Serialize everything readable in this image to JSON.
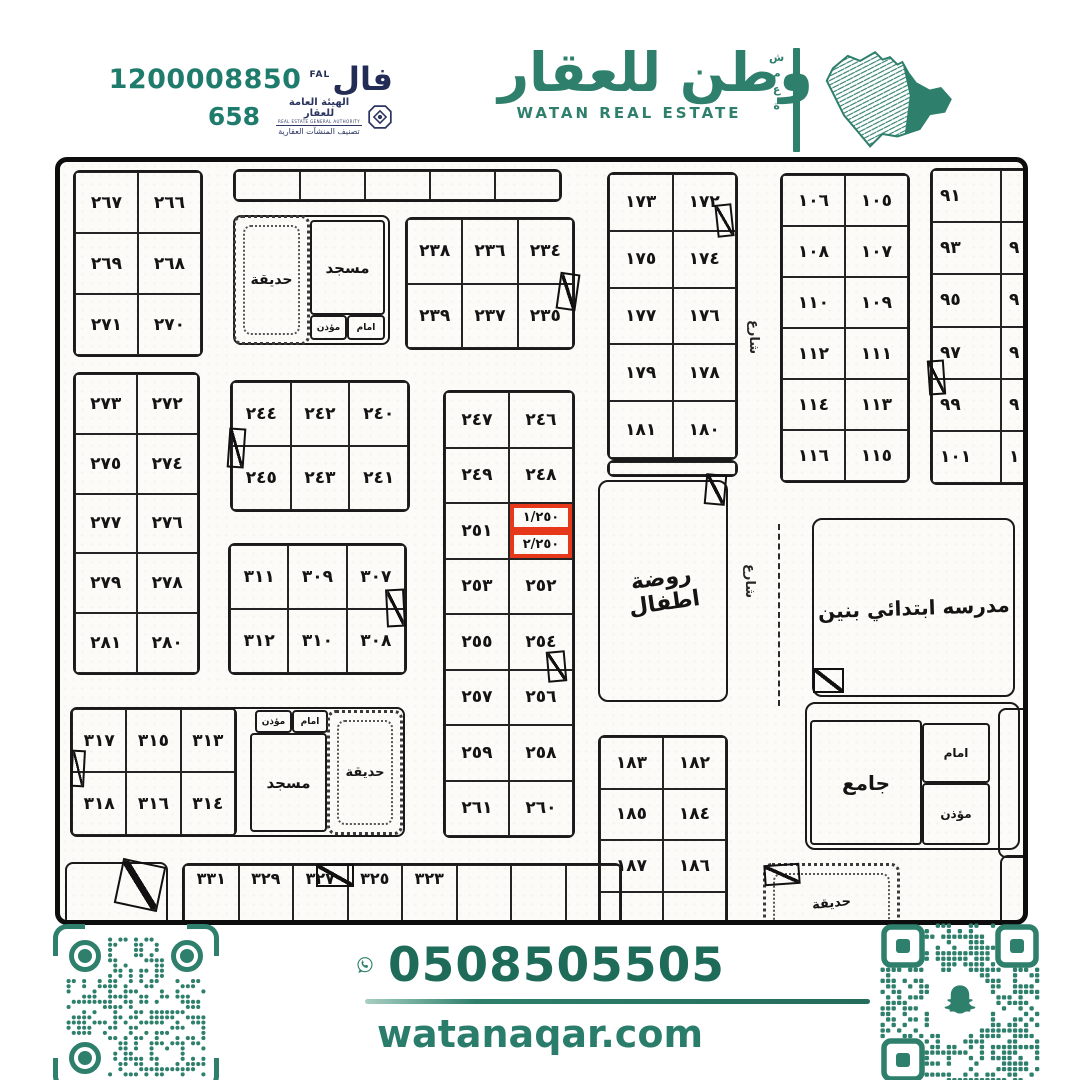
{
  "header": {
    "fal_number": "1200008850",
    "fal_logo_ar": "فال",
    "fal_logo_en": "FAL",
    "rega_number": "658",
    "rega_title_ar": "الهيئة العامة للعقار",
    "rega_title_en": "REAL ESTATE GENERAL AUTHORITY",
    "rega_subtitle_ar": "تصنيف المنشآت العقارية",
    "brand_ar": "وطن للعقار",
    "brand_en": "WATAN REAL ESTATE",
    "brand_vertical": "شمعة"
  },
  "footer": {
    "whatsapp_number": "0508505505",
    "website": "watanaqar.com"
  },
  "colors": {
    "teal": "#2e7f6b",
    "dark_teal": "#1d6b58",
    "navy": "#2b3560",
    "red": "#e8381c",
    "ink": "#161616"
  },
  "map": {
    "highlight_plots": [
      "١/٢٥٠",
      "٢/٢٥٠"
    ],
    "grids": [
      {
        "n": "block-266s",
        "x": 13,
        "y": 8,
        "w": 130,
        "h": 187,
        "c": 2,
        "r": [
          [
            "٢٦٧",
            "٢٦٦"
          ],
          [
            "٢٦٩",
            "٢٦٨"
          ],
          [
            "٢٧١",
            "٢٧٠"
          ]
        ]
      },
      {
        "n": "top-strip",
        "x": 173,
        "y": 7,
        "w": 329,
        "h": 33,
        "c": 5,
        "r": [
          [
            "",
            "",
            "",
            "",
            ""
          ]
        ]
      },
      {
        "n": "block-234s",
        "x": 345,
        "y": 55,
        "w": 170,
        "h": 133,
        "c": 3,
        "r": [
          [
            "٢٣٨",
            "٢٣٦",
            "٢٣٤"
          ],
          [
            "٢٣٩",
            "٢٣٧",
            "٢٣٥"
          ]
        ]
      },
      {
        "n": "block-172s",
        "x": 547,
        "y": 10,
        "w": 131,
        "h": 288,
        "c": 2,
        "r": [
          [
            "١٧٣",
            "١٧٢"
          ],
          [
            "١٧٥",
            "١٧٤"
          ],
          [
            "١٧٧",
            "١٧٦"
          ],
          [
            "١٧٩",
            "١٧٨"
          ],
          [
            "١٨١",
            "١٨٠"
          ]
        ]
      },
      {
        "n": "strip-172s",
        "x": 547,
        "y": 298,
        "w": 131,
        "h": 17,
        "c": 1,
        "r": [
          [
            ""
          ]
        ]
      },
      {
        "n": "block-246s",
        "x": 383,
        "y": 228,
        "w": 132,
        "h": 448,
        "c": 2,
        "r": [
          [
            "٢٤٧",
            "٢٤٦"
          ],
          [
            "٢٤٩",
            "٢٤٨"
          ],
          [
            "٢٥١",
            {
              "split": [
                "١/٢٥٠",
                "٢/٢٥٠"
              ]
            }
          ],
          [
            "٢٥٣",
            "٢٥٢"
          ],
          [
            "٢٥٥",
            "٢٥٤"
          ],
          [
            "٢٥٧",
            "٢٥٦"
          ],
          [
            "٢٥٩",
            "٢٥٨"
          ],
          [
            "٢٦١",
            "٢٦٠"
          ]
        ]
      },
      {
        "n": "block-240s",
        "x": 170,
        "y": 218,
        "w": 180,
        "h": 132,
        "c": 3,
        "r": [
          [
            "٢٤٤",
            "٢٤٢",
            "٢٤٠"
          ],
          [
            "٢٤٥",
            "٢٤٣",
            "٢٤١"
          ]
        ]
      },
      {
        "n": "block-307s",
        "x": 168,
        "y": 381,
        "w": 179,
        "h": 132,
        "c": 3,
        "r": [
          [
            "٣١١",
            "٣٠٩",
            "٣٠٧"
          ],
          [
            "٣١٢",
            "٣١٠",
            "٣٠٨"
          ]
        ]
      },
      {
        "n": "block-272s",
        "x": 13,
        "y": 210,
        "w": 127,
        "h": 303,
        "c": 2,
        "r": [
          [
            "٢٧٣",
            "٢٧٢"
          ],
          [
            "٢٧٥",
            "٢٧٤"
          ],
          [
            "٢٧٧",
            "٢٧٦"
          ],
          [
            "٢٧٩",
            "٢٧٨"
          ],
          [
            "٢٨١",
            "٢٨٠"
          ]
        ]
      },
      {
        "n": "block-313s",
        "x": 10,
        "y": 545,
        "w": 167,
        "h": 130,
        "c": 3,
        "r": [
          [
            "٣١٧",
            "٣١٥",
            "٣١٣"
          ],
          [
            "٣١٨",
            "٣١٦",
            "٣١٤"
          ]
        ]
      },
      {
        "n": "block-105s",
        "x": 720,
        "y": 11,
        "w": 130,
        "h": 310,
        "c": 2,
        "r": [
          [
            "١٠٦",
            "١٠٥"
          ],
          [
            "١٠٨",
            "١٠٧"
          ],
          [
            "١١٠",
            "١٠٩"
          ],
          [
            "١١٢",
            "١١١"
          ],
          [
            "١١٤",
            "١١٣"
          ],
          [
            "١١٦",
            "١١٥"
          ]
        ]
      },
      {
        "n": "block-91s",
        "x": 870,
        "y": 6,
        "w": 142,
        "h": 317,
        "c": 2,
        "align": "left",
        "r": [
          [
            "٩١",
            ""
          ],
          [
            "٩٣",
            "٩"
          ],
          [
            "٩٥",
            "٩"
          ],
          [
            "٩٧",
            "٩"
          ],
          [
            "٩٩",
            "٩"
          ],
          [
            "١٠١",
            "١"
          ]
        ]
      },
      {
        "n": "block-182s",
        "x": 538,
        "y": 573,
        "w": 130,
        "h": 210,
        "c": 2,
        "r": [
          [
            "١٨٣",
            "١٨٢"
          ],
          [
            "١٨٥",
            "١٨٤"
          ],
          [
            "١٨٧",
            "١٨٦"
          ],
          [
            "",
            ""
          ]
        ]
      },
      {
        "n": "bottom-strip",
        "x": 122,
        "y": 701,
        "w": 440,
        "h": 75,
        "c": 8,
        "top": true,
        "r": [
          [
            "٣٣١",
            "٣٢٩",
            "٣٢٧",
            "٣٢٥",
            "٣٢٣",
            "",
            "",
            ""
          ]
        ]
      }
    ],
    "boxes": [
      {
        "n": "compound-top-mosque-outline",
        "x": 173,
        "y": 53,
        "w": 157,
        "h": 130,
        "cls": "outline"
      },
      {
        "n": "garden-top",
        "x": 173,
        "y": 53,
        "w": 77,
        "h": 130,
        "cls": "dotted",
        "label": "حديقة",
        "fs": 14
      },
      {
        "n": "mosque-top",
        "x": 250,
        "y": 58,
        "w": 75,
        "h": 95,
        "label": "مسجد",
        "fs": 15
      },
      {
        "n": "muezzin-top",
        "x": 250,
        "y": 153,
        "w": 37,
        "h": 25,
        "label": "مؤذن",
        "fs": 9
      },
      {
        "n": "imam-top",
        "x": 287,
        "y": 153,
        "w": 38,
        "h": 25,
        "label": "امام",
        "fs": 9
      },
      {
        "n": "kindergarten",
        "x": 538,
        "y": 318,
        "w": 130,
        "h": 222,
        "cls": "round",
        "label": "روضة\nاطفال",
        "fs": 22,
        "rot": -8
      },
      {
        "n": "school",
        "x": 752,
        "y": 356,
        "w": 203,
        "h": 179,
        "cls": "round",
        "label": "مدرسه ابتدائي بنين",
        "fs": 20,
        "rot": -2
      },
      {
        "n": "compound-313-outline",
        "x": 10,
        "y": 545,
        "w": 335,
        "h": 130,
        "cls": "outline"
      },
      {
        "n": "muezzin-bl",
        "x": 195,
        "y": 548,
        "w": 37,
        "h": 23,
        "label": "مؤذن",
        "fs": 9
      },
      {
        "n": "imam-bl",
        "x": 232,
        "y": 548,
        "w": 36,
        "h": 23,
        "label": "امام",
        "fs": 9
      },
      {
        "n": "mosque-bl",
        "x": 190,
        "y": 571,
        "w": 77,
        "h": 99,
        "label": "مسجد",
        "fs": 15
      },
      {
        "n": "garden-bl",
        "x": 267,
        "y": 548,
        "w": 76,
        "h": 125,
        "cls": "dotted",
        "label": "حديقة",
        "fs": 13
      },
      {
        "n": "jame-outline",
        "x": 745,
        "y": 540,
        "w": 215,
        "h": 148,
        "cls": "outline round"
      },
      {
        "n": "jame-mosque",
        "x": 750,
        "y": 558,
        "w": 112,
        "h": 125,
        "label": "جامع",
        "fs": 20
      },
      {
        "n": "imam-jame",
        "x": 862,
        "y": 561,
        "w": 68,
        "h": 60,
        "label": "امام",
        "fs": 12
      },
      {
        "n": "muezzin-jame",
        "x": 862,
        "y": 621,
        "w": 68,
        "h": 62,
        "label": "مؤذن",
        "fs": 12
      },
      {
        "n": "garden-br",
        "x": 703,
        "y": 701,
        "w": 137,
        "h": 80,
        "cls": "dotted",
        "label": "حديقة",
        "fs": 13,
        "rot": -6
      },
      {
        "n": "partial-right-mid",
        "x": 938,
        "y": 546,
        "w": 50,
        "h": 150,
        "cls": "outline"
      },
      {
        "n": "partial-right-bottom",
        "x": 940,
        "y": 693,
        "w": 50,
        "h": 85,
        "cls": "outline"
      },
      {
        "n": "partial-bottom-left",
        "x": 5,
        "y": 700,
        "w": 103,
        "h": 78,
        "cls": "outline"
      }
    ],
    "flags": [
      {
        "x": 498,
        "y": 111,
        "w": 20,
        "h": 37,
        "rot": 8
      },
      {
        "x": 656,
        "y": 42,
        "w": 17,
        "h": 33,
        "rot": -6
      },
      {
        "x": 645,
        "y": 312,
        "w": 21,
        "h": 31,
        "rot": 5
      },
      {
        "x": 487,
        "y": 489,
        "w": 19,
        "h": 31,
        "rot": -5
      },
      {
        "x": 168,
        "y": 266,
        "w": 17,
        "h": 40,
        "rot": 4
      },
      {
        "x": 326,
        "y": 427,
        "w": 19,
        "h": 38,
        "rot": -3
      },
      {
        "x": 11,
        "y": 588,
        "w": 14,
        "h": 37,
        "rot": 3
      },
      {
        "x": 256,
        "y": 702,
        "w": 38,
        "h": 23,
        "rot": 0
      },
      {
        "x": 58,
        "y": 700,
        "w": 44,
        "h": 46,
        "rot": 12
      },
      {
        "x": 868,
        "y": 198,
        "w": 17,
        "h": 35,
        "rot": -4
      },
      {
        "x": 753,
        "y": 506,
        "w": 31,
        "h": 25,
        "rot": 0
      },
      {
        "x": 704,
        "y": 702,
        "w": 36,
        "h": 21,
        "rot": -4
      }
    ],
    "vlabels": [
      {
        "x": 686,
        "y": 158,
        "h": 66,
        "t": "شارع"
      },
      {
        "x": 682,
        "y": 402,
        "h": 108,
        "t": "شارع"
      }
    ],
    "dashes": [
      {
        "x": 718,
        "y": 362,
        "h": 182
      }
    ]
  }
}
